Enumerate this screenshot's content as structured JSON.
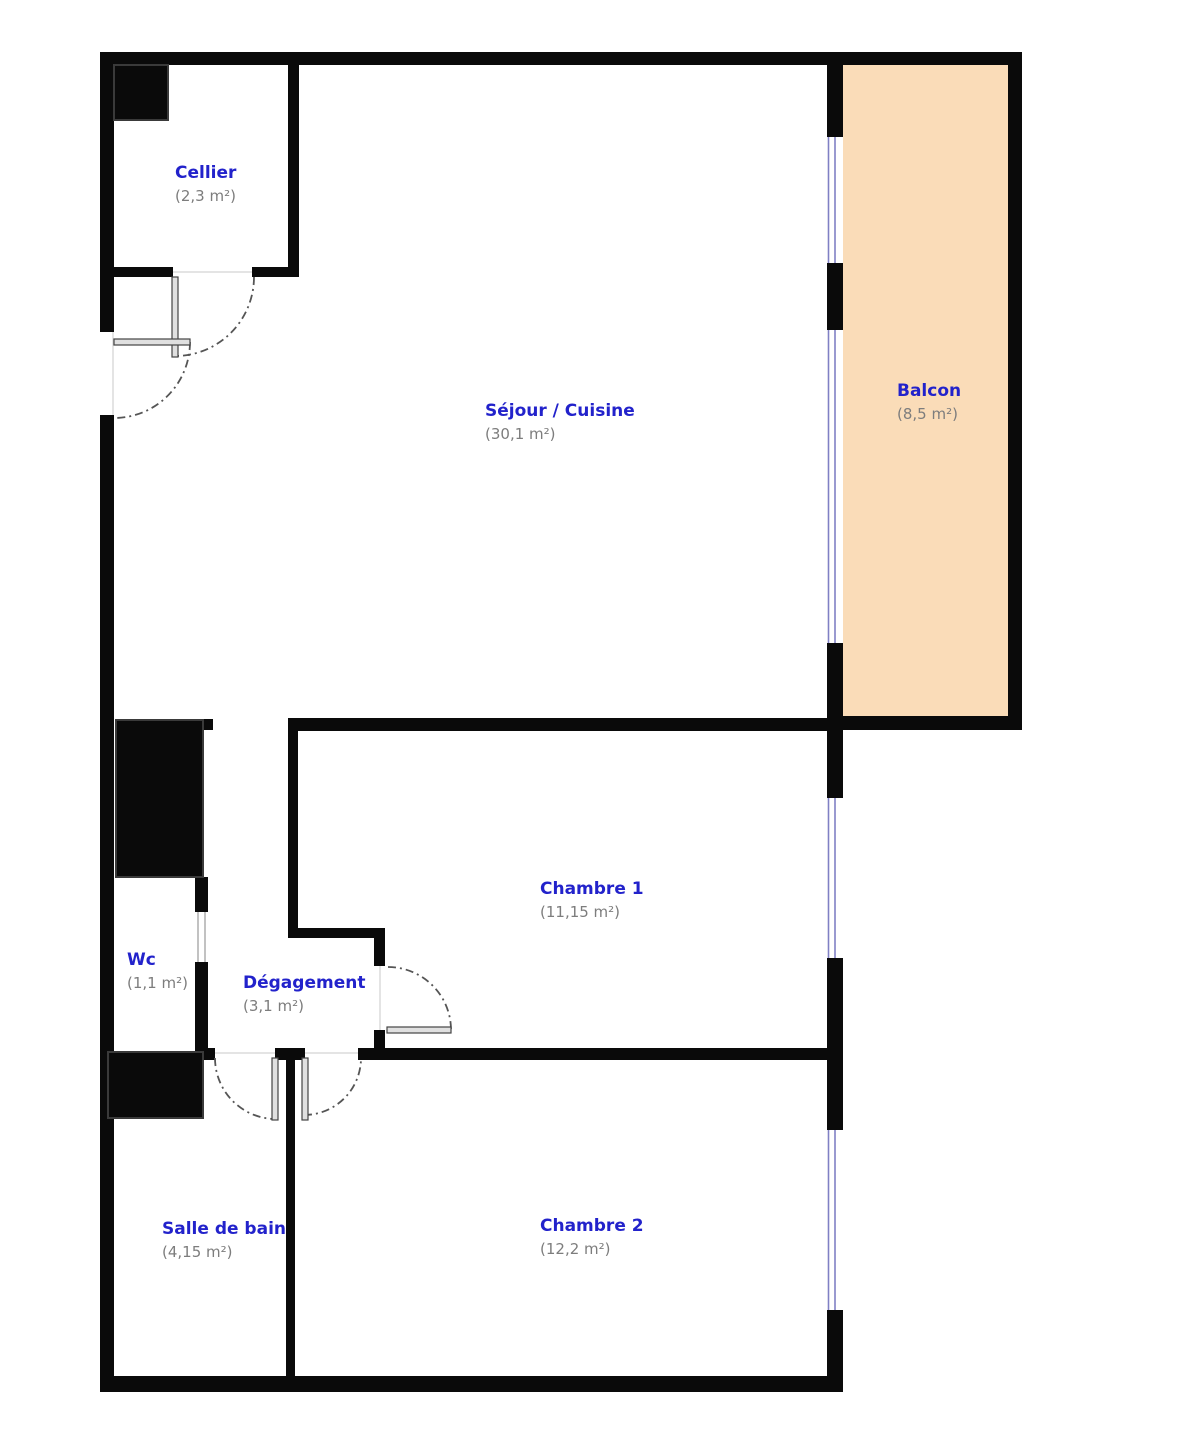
{
  "rooms": [
    {
      "name": "Cellier",
      "area": "(2,3 m²)"
    },
    {
      "name": "Séjour / Cuisine",
      "area": "(30,1 m²)"
    },
    {
      "name": "Balcon",
      "area": "(8,5 m²)"
    },
    {
      "name": "Chambre 1",
      "area": "(11,15 m²)"
    },
    {
      "name": "Wc",
      "area": "(1,1 m²)"
    },
    {
      "name": "Dégagement",
      "area": "(3,1 m²)"
    },
    {
      "name": "Salle de bain",
      "area": "(4,15 m²)"
    },
    {
      "name": "Chambre 2",
      "area": "(12,2 m²)"
    }
  ],
  "colors": {
    "wall": "#0a0a0a",
    "balcony_fill": "#fadcb8",
    "window_line": "#8080c4",
    "room_name_text": "#2222cb",
    "area_text": "#7d7d7d",
    "door_arc": "#555555",
    "door_leaf_fill": "#e0e0e0",
    "background": "#ffffff"
  }
}
